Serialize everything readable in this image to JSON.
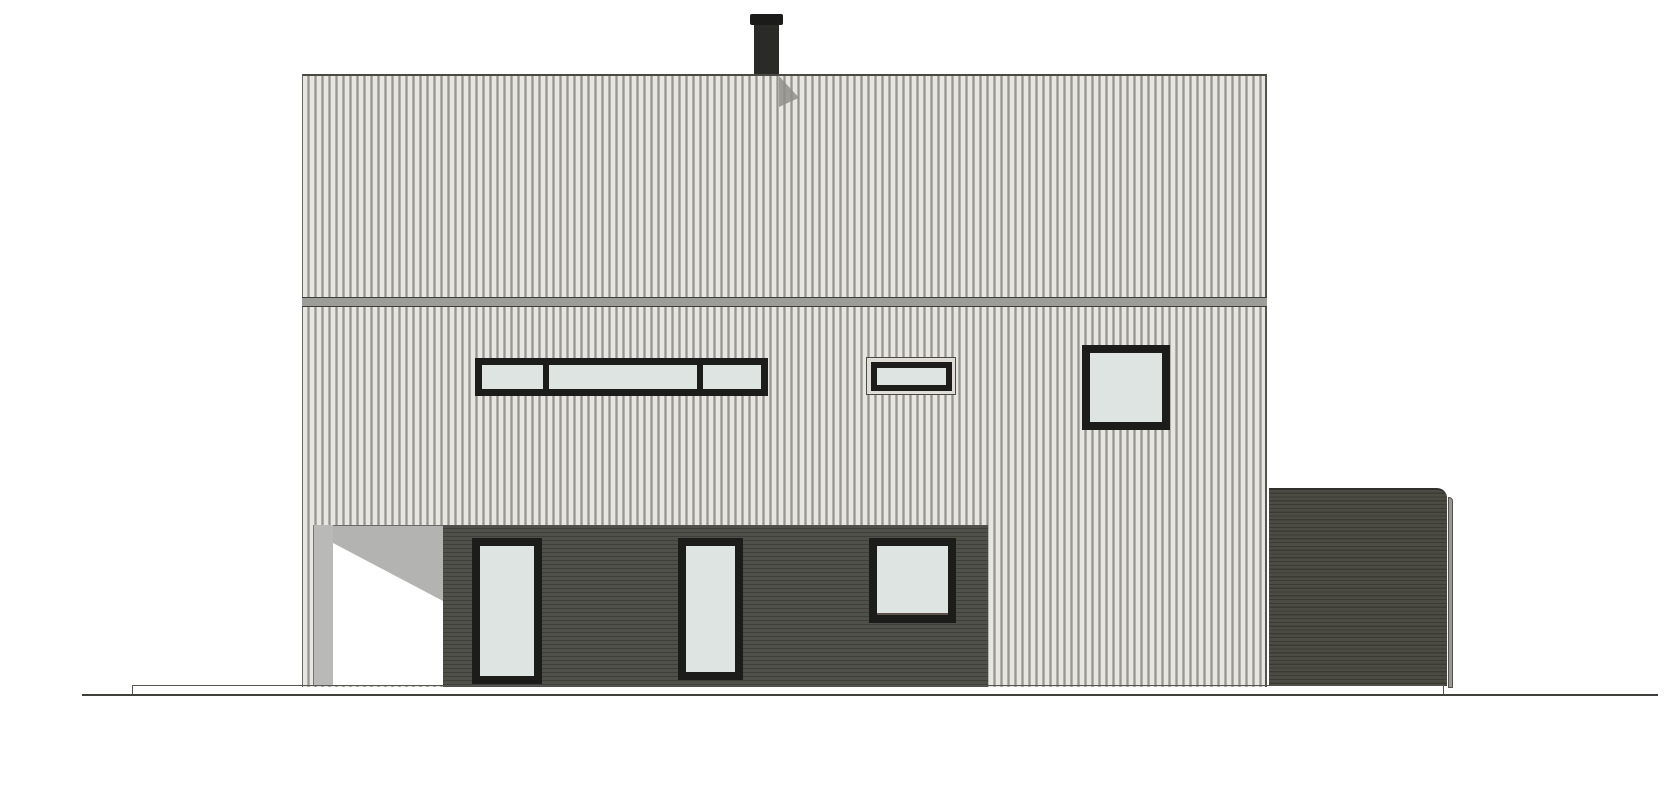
{
  "drawing": {
    "kind": "house-facade-elevation",
    "description": "Black-and-white architectural elevation of a two-storey house with cream vertical siding, dark-clad ground floor, carport opening, chimney and dark annex volume at right; no text labels visible",
    "text_labels": [],
    "elements": {
      "chimney": "chimney with cap on roof",
      "upper_facade": "roof-level band with vertical siding",
      "eaves_band": "horizontal eaves trim band",
      "main_facade": "upper-floor wall with vertical siding",
      "strip_window": "horizontal 3-pane strip window",
      "small_window": "small framed horizontal window",
      "square_window_upper": "square window upper floor",
      "dark_wall": "dark horizontally-clad ground-floor wall",
      "carport": "open carport recess with shadow",
      "door_1": "full-height glazed door 1",
      "door_2": "full-height glazed door 2",
      "square_window_lower": "square window ground floor",
      "annex": "dark flat-roofed annex volume at right",
      "foundation_line": "foundation / platform edge line",
      "ground_line": "ground line"
    },
    "counts": {
      "windows_upper_floor": 3,
      "doors_ground_floor": 2,
      "windows_ground_floor": 1
    }
  },
  "strip_window": {
    "pane_widths": [
      60,
      147,
      57
    ]
  },
  "palette": {
    "background": "#ffffff",
    "siding_light": "#e8e6e0",
    "siding_stripe": "#b3b1ab",
    "siding_stripe_dark": "#97958f",
    "eaves_fill": "#9c9c98",
    "eaves_edge": "#3e3e3a",
    "dark_cladding": "#50504a",
    "dark_cladding_stripe": "#3f3f39",
    "annex_cladding": "#4c4c45",
    "annex_stripe": "#3b3b35",
    "frame_black": "#1c1c1a",
    "glass": "#dde4e1",
    "carport_shadow": "#b3b3b1",
    "carport_jamb": "#b9b9b7",
    "chimney": "#2a2a27",
    "chimney_cap": "#1b1b19",
    "chimney_shadow": "#8f8f8b",
    "ground_line": "#3f3f3b",
    "foundation_line": "#55554f",
    "trim_gray": "#9a9894"
  }
}
